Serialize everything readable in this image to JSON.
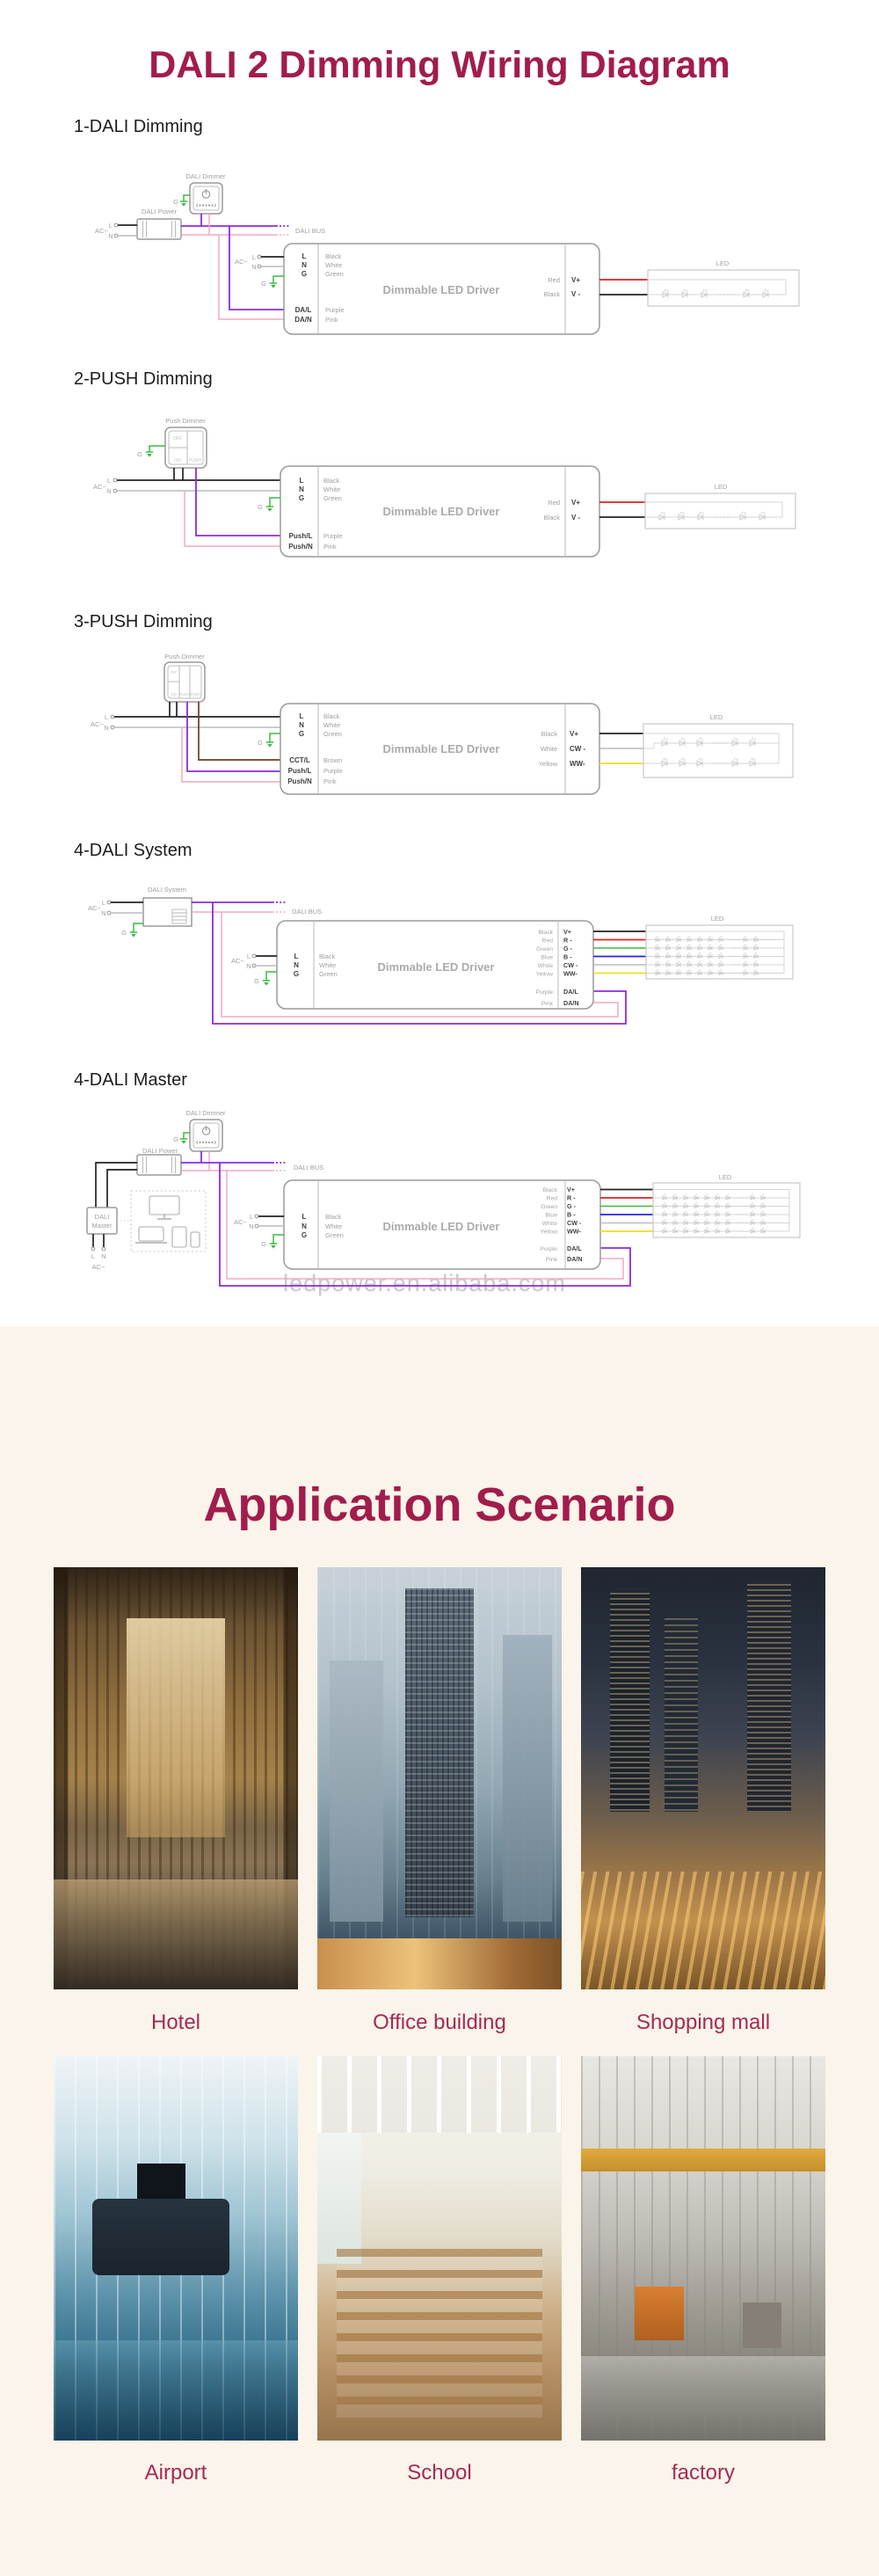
{
  "page": {
    "title": "DALI 2 Dimming Wiring Diagram",
    "watermark": "ledpower.en.alibaba.com"
  },
  "colors": {
    "title_red": "#A21C4C",
    "caption_red": "#A52A56",
    "beige_bg": "#FAF4EA",
    "wire_purple": "#8B2BE2",
    "wire_pink": "#F3A8C6",
    "wire_green": "#3CB843",
    "wire_red": "#E02020",
    "wire_blue": "#2525DD",
    "wire_yellow": "#EFE23C",
    "wire_brown": "#6E3B23"
  },
  "terms": {
    "ac": "AC~",
    "l": "L",
    "n": "N",
    "g": "G",
    "led": "LED",
    "dali_bus": "DALI BUS",
    "driver_name": "Dimmable LED Driver",
    "black": "Black",
    "white": "White",
    "green": "Green",
    "red": "Red",
    "blue": "Blue",
    "yellow": "Yellow",
    "brown": "Brown",
    "purple": "Purple",
    "pink": "Pink",
    "v_plus": "V+",
    "v_minus": "V -",
    "r_minus": "R -",
    "g_minus": "G -",
    "b_minus": "B -",
    "cw_minus": "CW -",
    "ww_minus": "WW-",
    "da_l": "DA/L",
    "da_n": "DA/N",
    "cct_l": "CCT/L",
    "push_l": "Push/L",
    "push_n": "Push/N",
    "off": "OFF",
    "on": "ON",
    "push": "PUSH",
    "dali_dimmer": "DALI Dimmer",
    "dali_power": "DALI Power",
    "push_dimmer": "Push Dimmer",
    "dali_system": "DALI System",
    "dali_master_1": "DALI",
    "dali_master_2": "Master"
  },
  "diagrams": [
    {
      "heading": "1-DALI Dimming"
    },
    {
      "heading": "2-PUSH Dimming"
    },
    {
      "heading": "3-PUSH Dimming"
    },
    {
      "heading": "4-DALI System"
    },
    {
      "heading": "4-DALI Master"
    }
  ],
  "application": {
    "title": "Application Scenario",
    "items": [
      {
        "label": "Hotel"
      },
      {
        "label": "Office building"
      },
      {
        "label": "Shopping mall"
      },
      {
        "label": "Airport"
      },
      {
        "label": "School"
      },
      {
        "label": "factory"
      }
    ]
  }
}
